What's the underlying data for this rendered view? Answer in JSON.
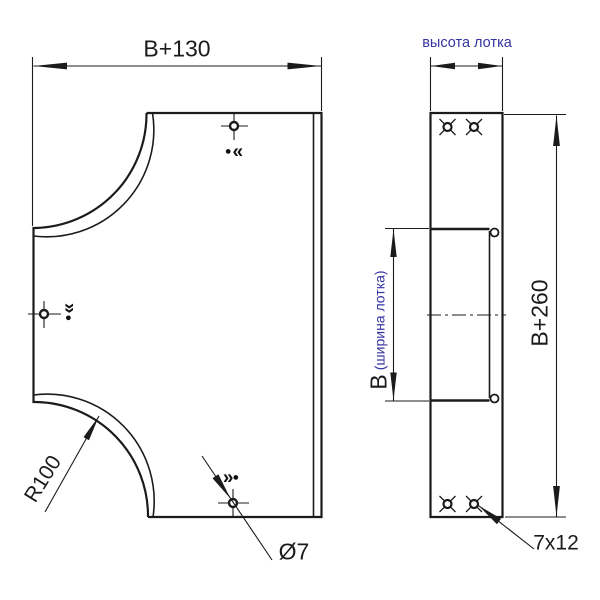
{
  "labels": {
    "b130": "B+130",
    "tray_height": "высота лотка",
    "b260": "B+260",
    "b": "B",
    "b_note": "(ширина лотка)",
    "r100": "R100",
    "dia": "Ø7",
    "slot": "7x12"
  },
  "symbols": {
    "dot": "●",
    "chev_left": "«",
    "chev_right": "»"
  },
  "colors": {
    "line": "#1b1b1b",
    "dimension_text": "#1b1b1b",
    "annotation_blue": "#3434a3",
    "background": "#ffffff"
  }
}
